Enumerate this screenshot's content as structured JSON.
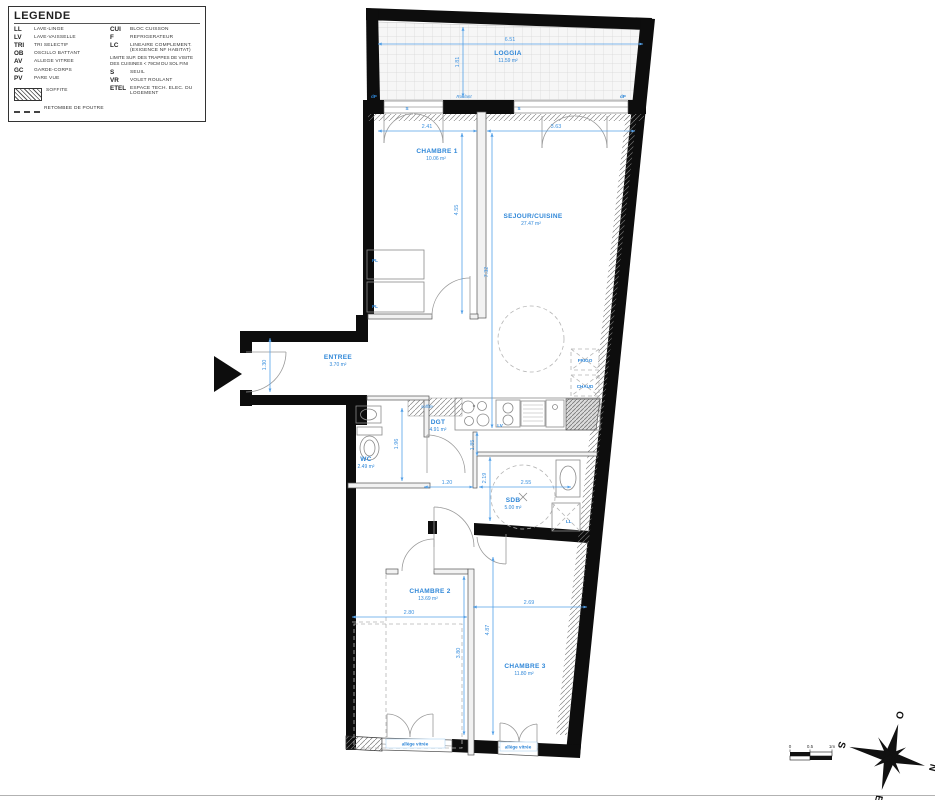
{
  "legend": {
    "title": "LEGENDE",
    "items_left": [
      {
        "abbr": "LL",
        "label": "LAVE-LINGE"
      },
      {
        "abbr": "LV",
        "label": "LAVE-VAISSELLE"
      },
      {
        "abbr": "TRI",
        "label": "TRI SELECTIF"
      },
      {
        "abbr": "OB",
        "label": "OSCILLO BATTANT"
      },
      {
        "abbr": "AV",
        "label": "ALLEGE VITREE"
      },
      {
        "abbr": "GC",
        "label": "GARDE-CORPS"
      },
      {
        "abbr": "PV",
        "label": "PARE VUE"
      }
    ],
    "soffite": "SOFFITE",
    "retombee": "RETOMBEE DE POUTRE",
    "items_right": [
      {
        "abbr": "CUI",
        "label": "BLOC CUISSON"
      },
      {
        "abbr": "F",
        "label": "REFRIGERATEUR"
      },
      {
        "abbr": "LC",
        "label": "LINEAIRE COMPLEMENT. (EXIGENCE NF HABITAT)"
      }
    ],
    "note": "LIMITE SUP. DES TRAPPES DE VISITE DES CUISINES < 79CM DU SOL FINI",
    "items_right2": [
      {
        "abbr": "S",
        "label": "SEUIL"
      },
      {
        "abbr": "VR",
        "label": "VOLET ROULANT"
      },
      {
        "abbr": "ETEL",
        "label": "ESPACE TECH. ELEC. DU LOGEMENT"
      }
    ]
  },
  "rooms": {
    "loggia": {
      "name": "LOGGIA",
      "area": "11.59 m²"
    },
    "chambre1": {
      "name": "CHAMBRE 1",
      "area": "10.06 m²"
    },
    "sejour": {
      "name": "SEJOUR/CUISINE",
      "area": "27.47 m²"
    },
    "entree": {
      "name": "ENTREE",
      "area": "3.70 m²"
    },
    "dgt": {
      "name": "DGT",
      "area": "4.91 m²"
    },
    "wc": {
      "name": "WC",
      "area": "2.49 m²"
    },
    "sdb": {
      "name": "SDB",
      "area": "5.00 m²"
    },
    "chambre2": {
      "name": "CHAMBRE 2",
      "area": "13.69 m²"
    },
    "chambre3": {
      "name": "CHAMBRE 3",
      "area": "11.80 m²"
    }
  },
  "dims": {
    "loggia_w": "6.51",
    "loggia_d": "1.81",
    "ch1_w": "2.41",
    "sej_w": "3.63",
    "ch1_h": "4.55",
    "sej_h": "7.32",
    "entree_h": "1.30",
    "wc_h": "1.96",
    "hall_w": "1.20",
    "sdb_h": "2.19",
    "sdb_w": "2.55",
    "kitchen_w": "1.85",
    "ch2_w": "2.80",
    "ch2_h": "3.80",
    "ch3_w": "2.69",
    "ch3_h": "4.87"
  },
  "tags": {
    "dp": "dP",
    "seuil": "S",
    "soffite": "soffite",
    "roulant": "Roulant",
    "pl": "PL",
    "lv": "LV",
    "ll": "LL",
    "frigo": "FRIGO",
    "chaud": "CHAUD",
    "allege": "allège vitrée"
  },
  "compass": {
    "n": "N",
    "s": "S",
    "e": "E",
    "o": "O"
  },
  "scalebar": {
    "zero": "0",
    "half": "0.5",
    "one": "1m"
  },
  "colors": {
    "accent": "#2f87d8",
    "dim": "#54a1e8",
    "wall": "#0d0d0d"
  }
}
